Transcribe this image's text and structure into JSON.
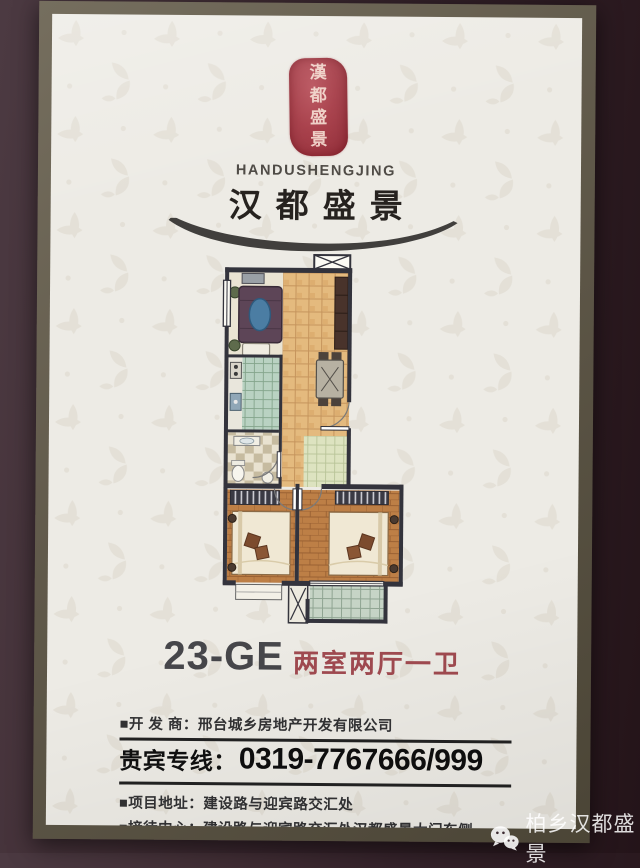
{
  "photo": {
    "watermark": {
      "icon": "wechat-icon",
      "text": "柏乡汉都盛景"
    }
  },
  "flyer": {
    "brand": {
      "seal_chars": [
        "漢",
        "都",
        "盛",
        "景"
      ],
      "latin_name": "HANDUSHENGJING",
      "cn_name": "汉都盛景"
    },
    "unit": {
      "code": "23-GE",
      "layout": "两室两厅一卫"
    },
    "info": {
      "developer_label": "■开 发 商：",
      "developer_value": "邢台城乡房地产开发有限公司",
      "vip_label": "贵宾专线：",
      "vip_phone": "0319-7767666/999",
      "address_label": "■项目地址：",
      "address_value": "建设路与迎宾路交汇处",
      "reception_label": "■接待中心：",
      "reception_value": "建设路与迎宾路交汇处汉都盛景大门东侧"
    },
    "colors": {
      "seal_red": "#a83d46",
      "unit_type_red": "#a04a50",
      "paper": "#edebe5",
      "frame_olive": "#5f5947",
      "backdrop": "#38252c"
    }
  }
}
